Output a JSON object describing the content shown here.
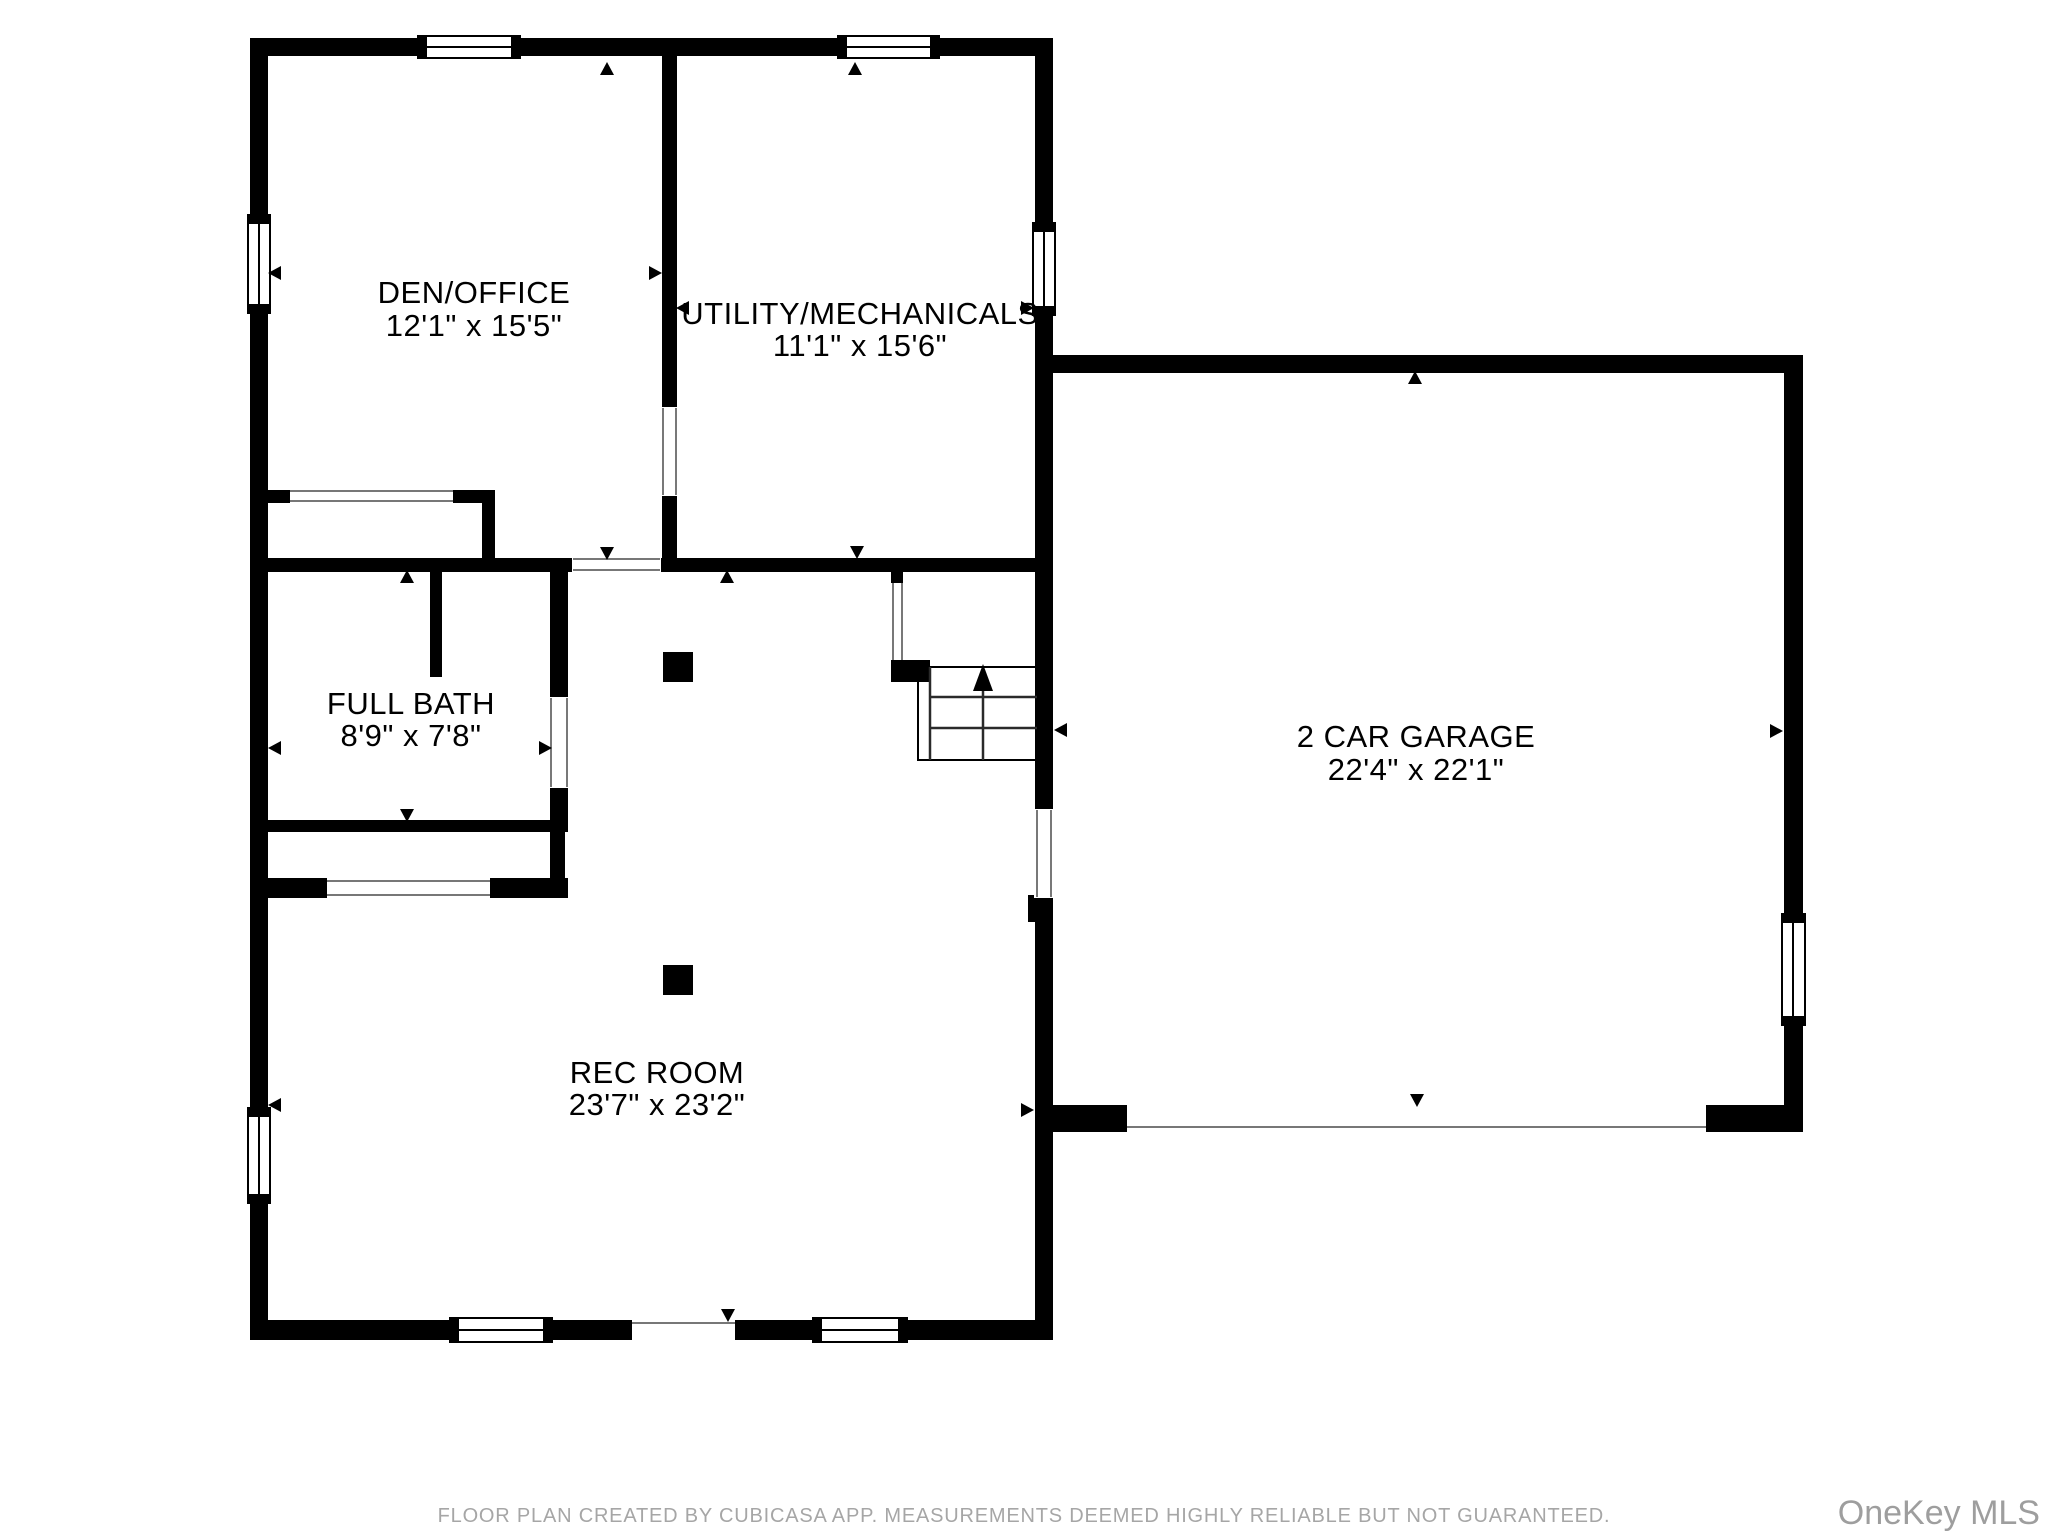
{
  "document": {
    "type": "basement floor plan",
    "background_color": "#ffffff",
    "wall_color": "#000000",
    "label_color": "#000000",
    "muted_text_color": "#a6a6a6"
  },
  "rooms": [
    {
      "id": "den-office",
      "name": "DEN/OFFICE",
      "dimensions": "12'1\" x 15'5\""
    },
    {
      "id": "utility-mechanicals",
      "name": "UTILITY/MECHANICALS",
      "dimensions": "11'1\" x 15'6\""
    },
    {
      "id": "full-bath",
      "name": "FULL BATH",
      "dimensions": "8'9\" x 7'8\""
    },
    {
      "id": "rec-room",
      "name": "REC ROOM",
      "dimensions": "23'7\" x 23'2\""
    },
    {
      "id": "two-car-garage",
      "name": "2 CAR GARAGE",
      "dimensions": "22'4\" x 22'1\""
    }
  ],
  "symbols": {
    "dimension_arrow_icon": "▲",
    "stairs_up_arrow_icon": "↑",
    "window_symbol": "white bar with black end caps and center line",
    "door_symbol": "white gap in wall"
  },
  "footer": {
    "disclaimer": "FLOOR PLAN CREATED BY CUBICASA APP. MEASUREMENTS DEEMED HIGHLY RELIABLE BUT NOT GUARANTEED."
  },
  "watermark": {
    "text": "OneKey MLS"
  }
}
